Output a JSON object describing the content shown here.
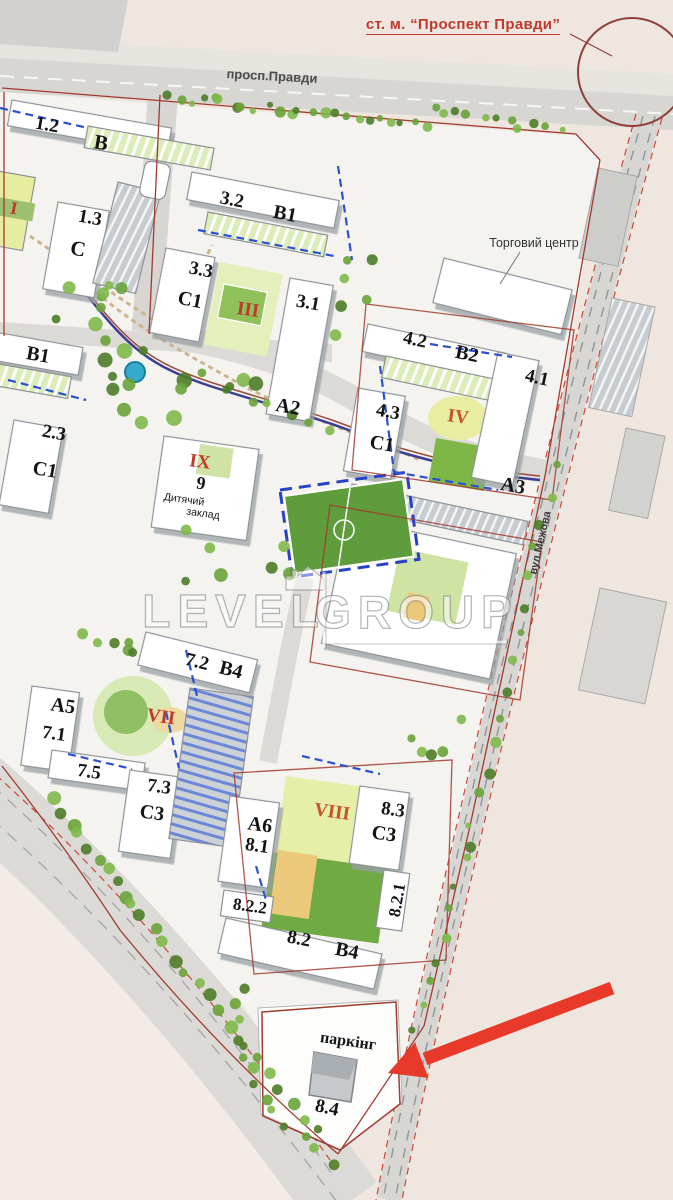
{
  "labels": {
    "metro_station": "ст. м. “Проспект Правди”",
    "avenue": "просп.Правди",
    "street": "вул.Межова",
    "shopping_center": "Торговий центр",
    "kindergarten_line1": "Дитячий",
    "kindergarten_line2": "заклад",
    "parking": "паркінг"
  },
  "districts": {
    "i": "I",
    "iii": "III",
    "iv": "IV",
    "vii": "VII",
    "viii": "VIII",
    "ix": "IX"
  },
  "buildings": {
    "n1_2": "1.2",
    "letter_b": "B",
    "n1_3": "1.3",
    "letter_c": "C",
    "n3_2": "3.2",
    "letter_b1": "B1",
    "n3_3": "3.3",
    "letter_c1": "C1",
    "n3_1": "3.1",
    "letter_a2": "A2",
    "n2_3": "2.3",
    "n4_2": "4.2",
    "letter_b2": "B2",
    "n4_1": "4.1",
    "n4_3": "4.3",
    "letter_a3": "A3",
    "n9": "9",
    "n7_2": "7.2",
    "letter_b4": "B4",
    "letter_a5": "A5",
    "n7_1": "7.1",
    "n7_5": "7.5",
    "n7_3": "7.3",
    "letter_c3": "C3",
    "letter_a6": "A6",
    "n8_1": "8.1",
    "n8_3": "8.3",
    "n8_2_2": "8.2.2",
    "n8_2_1": "8.2.1",
    "n8_2": "8.2",
    "n8_4": "8.4"
  },
  "watermark": {
    "left": "LEVEL",
    "right": "GROUP"
  },
  "colors": {
    "accent_red": "#bf3a2d",
    "arrow_red": "#e8392b",
    "boundary_red": "#a23a2e",
    "water_blue": "#35aacd",
    "field_green": "#5e9c3c",
    "dash_blue": "#2b50d0"
  }
}
